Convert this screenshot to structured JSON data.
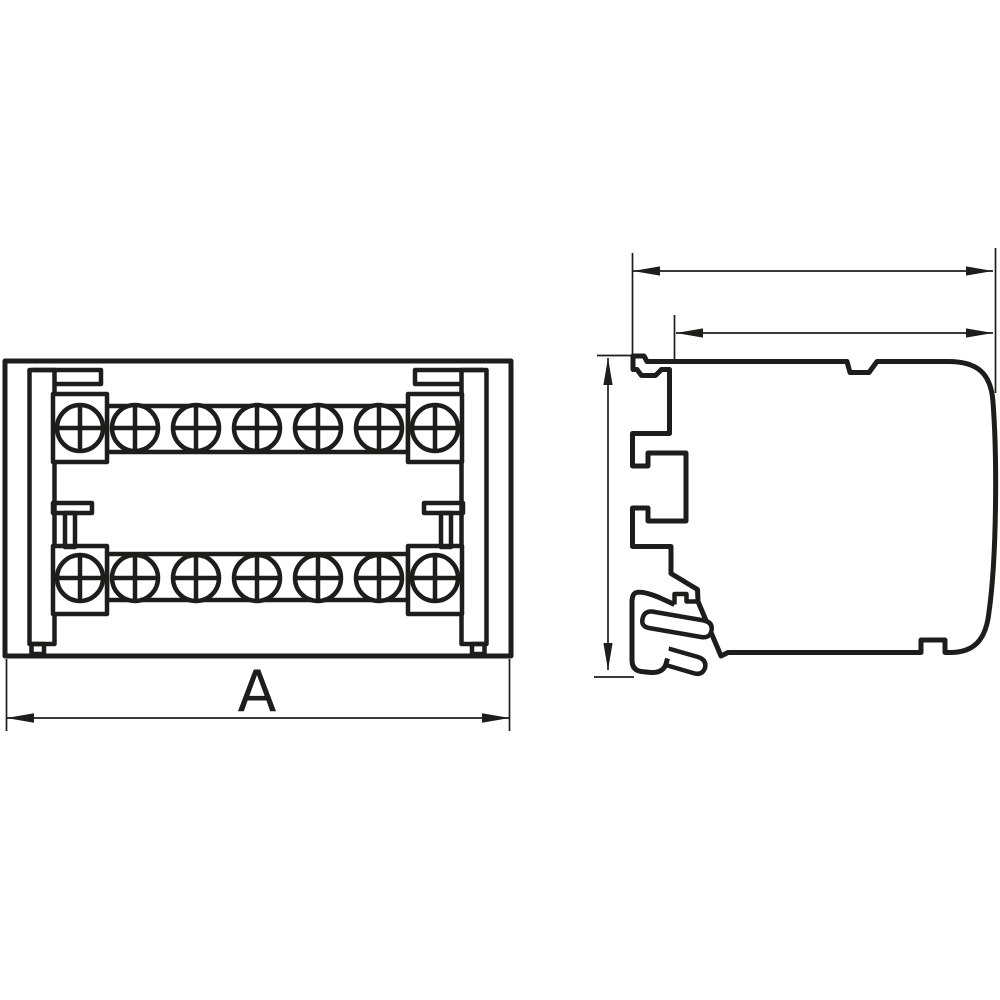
{
  "drawing": {
    "background": "#ffffff",
    "line_color": "#1d1d1b",
    "front_view": {
      "dimension_label": "A",
      "screw_rows": 2,
      "screws_per_row": 7,
      "screw_columns_x": [
        80,
        135,
        196,
        257,
        318,
        379,
        435
      ],
      "screw_rows_y": [
        428,
        578
      ],
      "screw_radius": 23,
      "screw_cross_arm": 25
    },
    "side_view": {
      "unlabeled_dimension_arrows": 3
    }
  }
}
